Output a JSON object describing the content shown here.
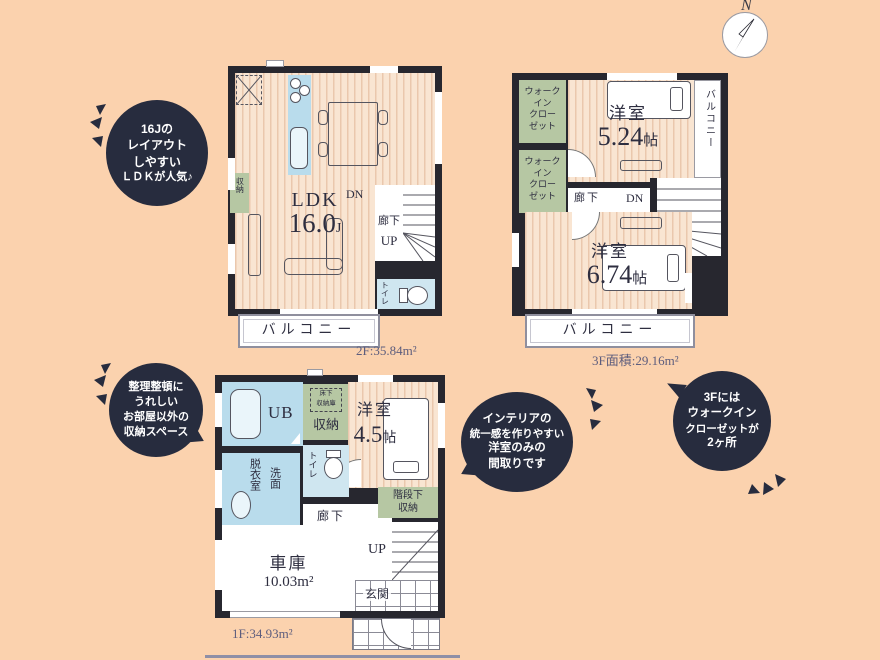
{
  "compass": {
    "north": "N"
  },
  "bubbles": [
    {
      "lines": [
        "16Jの",
        "レイアウト",
        "しやすい",
        "ＬＤＫが人気♪"
      ]
    },
    {
      "lines": [
        "整理整頓に",
        "うれしい",
        "お部屋以外の",
        "収納スペース"
      ]
    },
    {
      "lines": [
        "インテリアの",
        "統一感を作りやすい",
        "洋室のみの",
        "間取りです"
      ]
    },
    {
      "lines": [
        "3Fには",
        "ウォークイン",
        "クローゼットが",
        "2ヶ所"
      ]
    }
  ],
  "floor2": {
    "area": "2F:35.84m²",
    "ldk": "LDK",
    "ldk_size": "16.0",
    "ldk_unit": "J",
    "storage": "収納",
    "dn": "DN",
    "hall": "廊下",
    "up": "UP",
    "toilet": "トイレ",
    "balcony": "バルコニー"
  },
  "floor3": {
    "area": "3F面積:29.16m²",
    "wic_lines": [
      "ウォーク",
      "イン",
      "クロー",
      "ゼット"
    ],
    "bedroom1": "洋室",
    "bedroom1_size": "5.24",
    "bedroom1_unit": "帖",
    "bedroom2": "洋室",
    "bedroom2_size": "6.74",
    "bedroom2_unit": "帖",
    "hall": "廊下",
    "dn": "DN",
    "balcony_side": "バルコニー",
    "balcony_bottom": "バルコニー"
  },
  "floor1": {
    "area": "1F:34.93m²",
    "ub": "UB",
    "storage": "収納",
    "underfloor_lines": [
      "床下",
      "収納庫"
    ],
    "bedroom": "洋室",
    "bedroom_size": "4.5",
    "bedroom_unit": "帖",
    "toilet": "トイレ",
    "dressing": "脱衣室",
    "wash": "洗面",
    "hall": "廊下",
    "stair_storage_lines": [
      "階段下",
      "収納"
    ],
    "garage": "車庫",
    "garage_size": "10.03m²",
    "up": "UP",
    "entrance": "玄関"
  }
}
